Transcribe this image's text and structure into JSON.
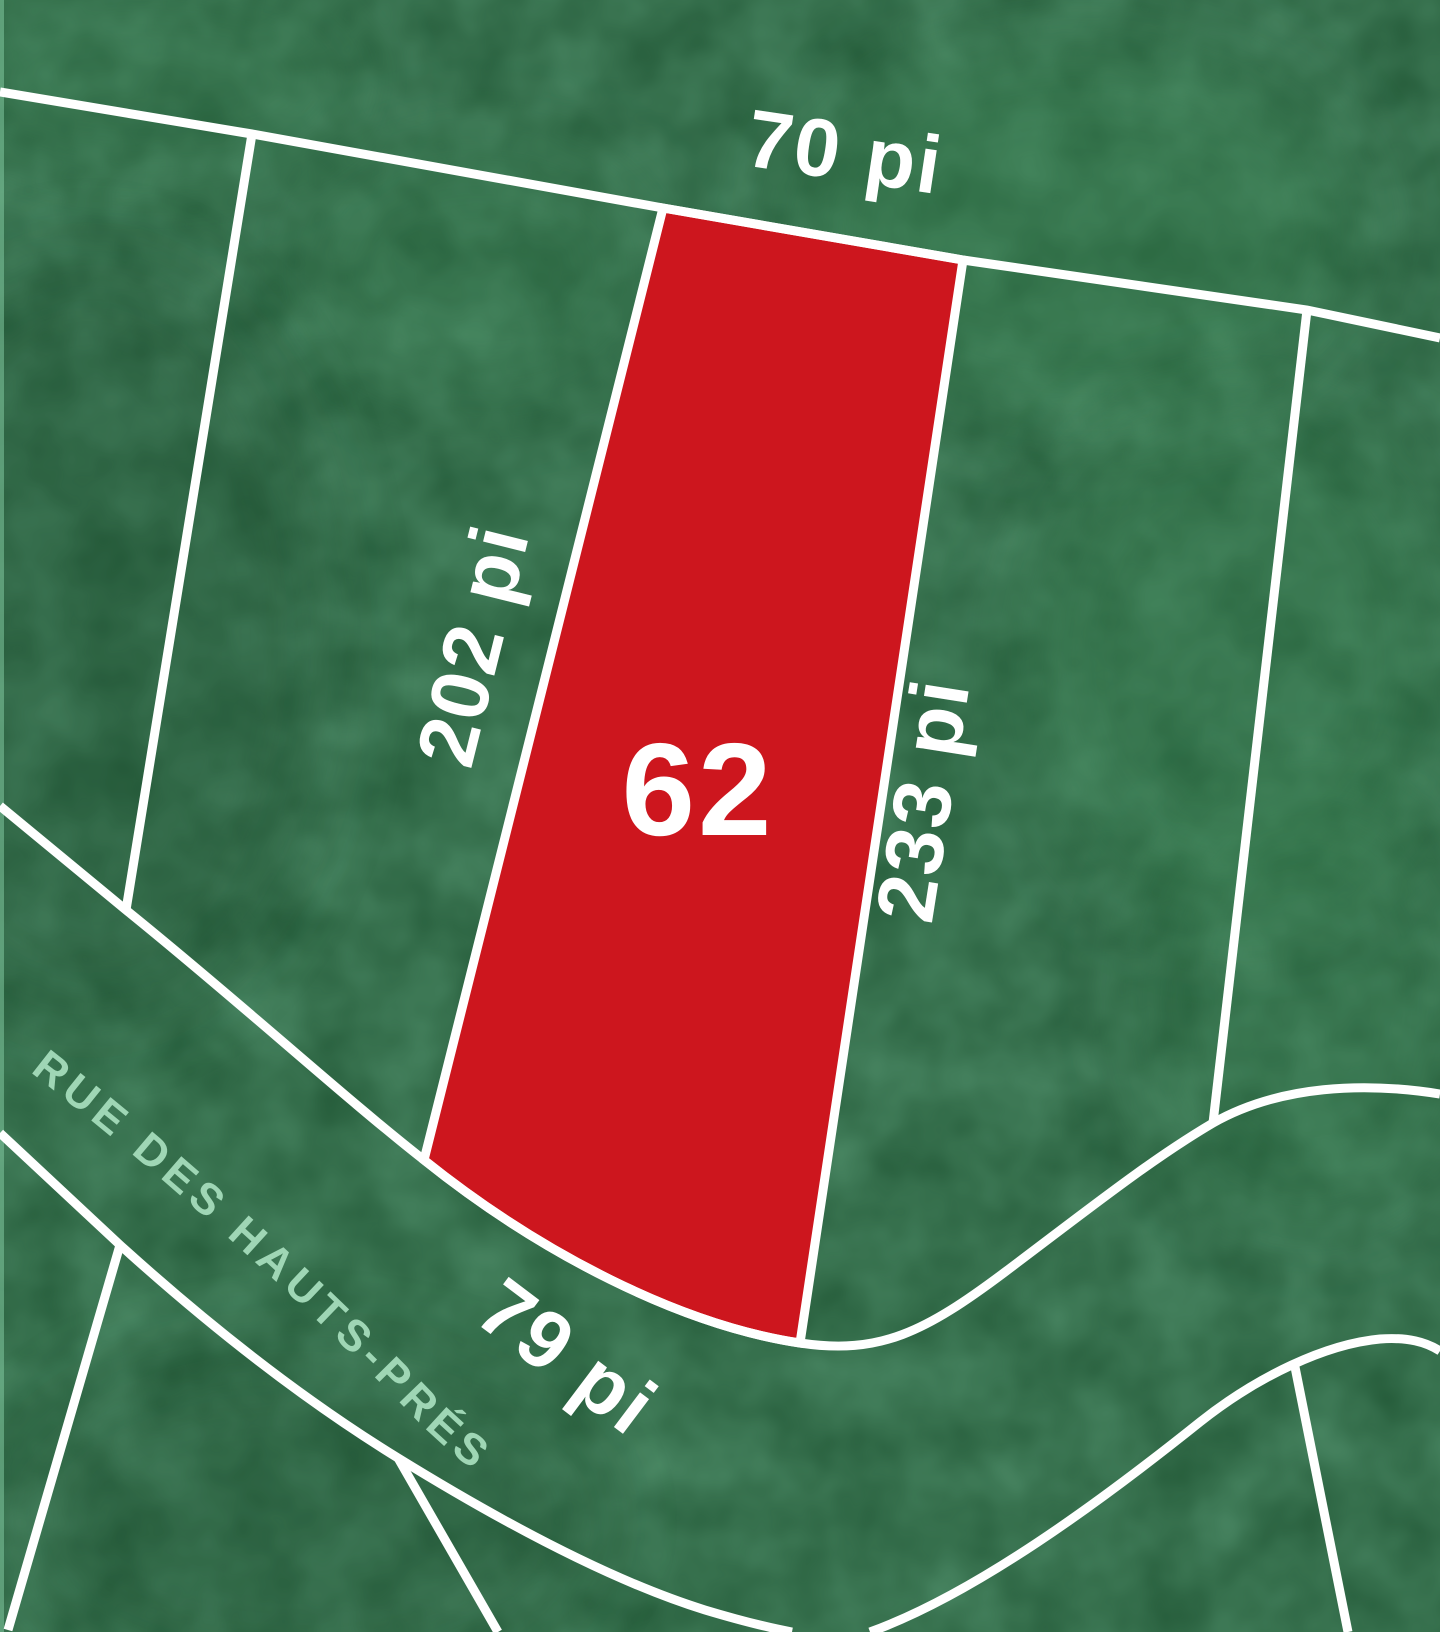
{
  "map": {
    "type": "subdivision-lot-plan",
    "street": {
      "name": "RUE DES HAUTS-PRÉS"
    },
    "highlighted_lot": {
      "number": "62"
    },
    "dimensions": {
      "top": "70 pi",
      "left": "202 pi",
      "right": "233 pi",
      "bottom": "79 pi"
    },
    "colors": {
      "background_green": "#2d6a45",
      "texture_green_light": "#3e8a57",
      "lot_highlight_red": "#cd161e",
      "boundary_white": "#ffffff",
      "street_text_mint": "#9fd6b5"
    }
  }
}
